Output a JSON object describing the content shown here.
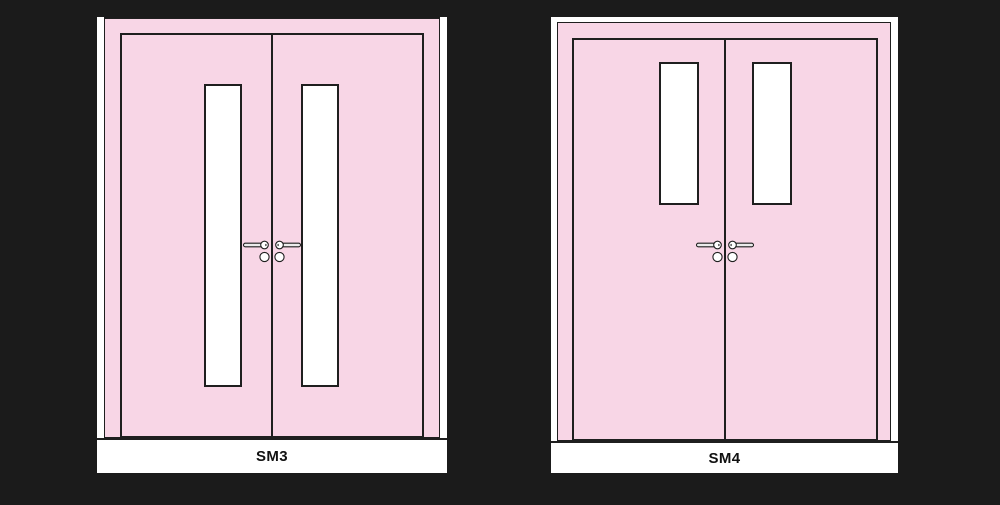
{
  "scene": {
    "background_color": "#1b1b1b",
    "door_panel_color": "#f8d6e6",
    "outline_color": "#1f1f1f",
    "trim_color": "#ffffff",
    "hardware_fill_color": "#ececec"
  },
  "doors": [
    {
      "label": "SM3",
      "type": "double-leaf door elevation",
      "vision_panels": "tall narrow glazed panels, 2",
      "hardware": "paired lever handles with cylinder roses at meeting stile"
    },
    {
      "label": "SM4",
      "type": "double-leaf door elevation",
      "vision_panels": "short upper glazed panels, 2",
      "hardware": "paired lever handles with cylinder roses at meeting stile"
    }
  ]
}
